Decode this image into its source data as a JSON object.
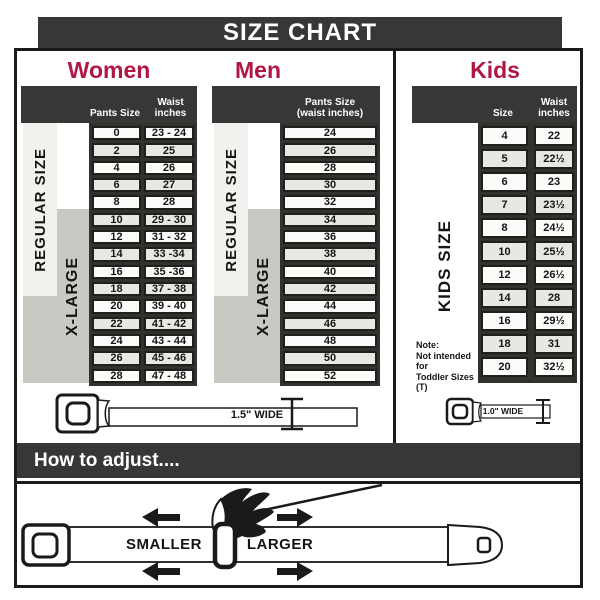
{
  "title": "SIZE CHART",
  "colors": {
    "accent": "#b01745",
    "dark": "#383735"
  },
  "sections": {
    "women": {
      "heading": "Women",
      "columns": {
        "size": "Pants Size",
        "waist": "Waist\ninches"
      },
      "bands": {
        "regular": "REGULAR SIZE",
        "xlarge": "X-LARGE"
      },
      "rows": [
        {
          "size": "0",
          "waist": "23 - 24"
        },
        {
          "size": "2",
          "waist": "25"
        },
        {
          "size": "4",
          "waist": "26"
        },
        {
          "size": "6",
          "waist": "27"
        },
        {
          "size": "8",
          "waist": "28"
        },
        {
          "size": "10",
          "waist": "29 - 30"
        },
        {
          "size": "12",
          "waist": "31 - 32"
        },
        {
          "size": "14",
          "waist": "33 -34"
        },
        {
          "size": "16",
          "waist": "35 -36"
        },
        {
          "size": "18",
          "waist": "37 - 38"
        },
        {
          "size": "20",
          "waist": "39 - 40"
        },
        {
          "size": "22",
          "waist": "41 - 42"
        },
        {
          "size": "24",
          "waist": "43 - 44"
        },
        {
          "size": "26",
          "waist": "45 - 46"
        },
        {
          "size": "28",
          "waist": "47 - 48"
        }
      ],
      "belt_width_label": "1.5\" WIDE"
    },
    "men": {
      "heading": "Men",
      "columns": {
        "size": "Pants Size\n(waist inches)"
      },
      "bands": {
        "regular": "REGULAR SIZE",
        "xlarge": "X-LARGE"
      },
      "rows": [
        "24",
        "26",
        "28",
        "30",
        "32",
        "34",
        "36",
        "38",
        "40",
        "42",
        "44",
        "46",
        "48",
        "50",
        "52"
      ]
    },
    "kids": {
      "heading": "Kids",
      "columns": {
        "size": "Size",
        "waist": "Waist\ninches"
      },
      "band": "KIDS SIZE",
      "note": "Note:\nNot intended for\nToddler Sizes (T)",
      "rows": [
        {
          "size": "4",
          "waist": "22"
        },
        {
          "size": "5",
          "waist": "22½"
        },
        {
          "size": "6",
          "waist": "23"
        },
        {
          "size": "7",
          "waist": "23½"
        },
        {
          "size": "8",
          "waist": "24½"
        },
        {
          "size": "10",
          "waist": "25½"
        },
        {
          "size": "12",
          "waist": "26½"
        },
        {
          "size": "14",
          "waist": "28"
        },
        {
          "size": "16",
          "waist": "29½"
        },
        {
          "size": "18",
          "waist": "31"
        },
        {
          "size": "20",
          "waist": "32½"
        }
      ],
      "belt_width_label": "1.0\" WIDE"
    }
  },
  "how_to_adjust": {
    "heading": "How to adjust....",
    "smaller": "SMALLER",
    "larger": "LARGER"
  }
}
